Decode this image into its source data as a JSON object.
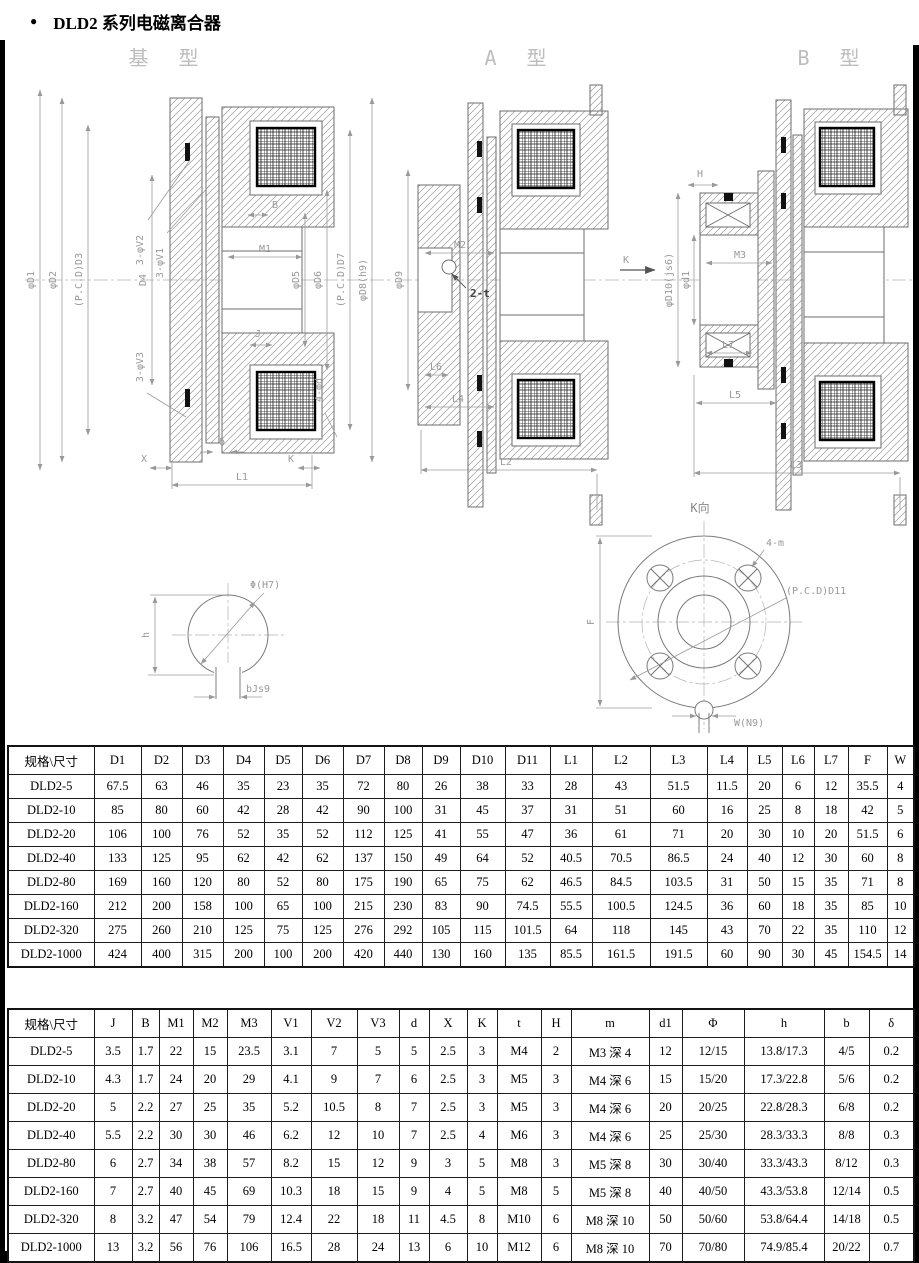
{
  "page": {
    "bullet": "●",
    "title": "DLD2 系列电磁离合器"
  },
  "drawings": {
    "base": {
      "label": "基 型",
      "ann": {
        "phiD1": "φD1",
        "phiD2": "φD2",
        "pcdD3": "(P.C.D)D3",
        "D4": "D4",
        "v2": "3-φV2",
        "v1": "3-φV1",
        "B": "B",
        "M1": "M1",
        "phiD5": "φD5",
        "phiD6": "φD6",
        "pcdD7": "(P.C.D)D7",
        "phiD8": "φD8(h9)",
        "v3": "3-φV3",
        "J": "J",
        "phid": "4-φd",
        "X": "X",
        "delta": "δ",
        "K": "K",
        "L1": "L1"
      }
    },
    "typeA": {
      "label": "A 型",
      "ann": {
        "phiD9": "φD9",
        "M2": "M2",
        "t2": "2-t",
        "L6": "L6",
        "L4": "L4",
        "L2": "L2",
        "K": "K"
      }
    },
    "typeB": {
      "label": "B 型",
      "ann": {
        "H": "H",
        "phiD10": "φD10(js6)",
        "phid1": "φd1",
        "M3": "M3",
        "L7": "L7",
        "L5": "L5",
        "L3": "L3"
      }
    },
    "keyway": {
      "ann": {
        "phi": "Φ(H7)",
        "h": "h",
        "b": "bJs9"
      }
    },
    "flange": {
      "ann": {
        "kview": "K向",
        "m4": "4-m",
        "pcd": "(P.C.D)D11",
        "F": "F",
        "W": "W(N9)"
      }
    }
  },
  "table1": {
    "headers": [
      "规格\\尺寸",
      "D1",
      "D2",
      "D3",
      "D4",
      "D5",
      "D6",
      "D7",
      "D8",
      "D9",
      "D10",
      "D11",
      "L1",
      "L2",
      "L3",
      "L4",
      "L5",
      "L6",
      "L7",
      "F",
      "W"
    ],
    "rows": [
      [
        "DLD2-5",
        "67.5",
        "63",
        "46",
        "35",
        "23",
        "35",
        "72",
        "80",
        "26",
        "38",
        "33",
        "28",
        "43",
        "51.5",
        "11.5",
        "20",
        "6",
        "12",
        "35.5",
        "4"
      ],
      [
        "DLD2-10",
        "85",
        "80",
        "60",
        "42",
        "28",
        "42",
        "90",
        "100",
        "31",
        "45",
        "37",
        "31",
        "51",
        "60",
        "16",
        "25",
        "8",
        "18",
        "42",
        "5"
      ],
      [
        "DLD2-20",
        "106",
        "100",
        "76",
        "52",
        "35",
        "52",
        "112",
        "125",
        "41",
        "55",
        "47",
        "36",
        "61",
        "71",
        "20",
        "30",
        "10",
        "20",
        "51.5",
        "6"
      ],
      [
        "DLD2-40",
        "133",
        "125",
        "95",
        "62",
        "42",
        "62",
        "137",
        "150",
        "49",
        "64",
        "52",
        "40.5",
        "70.5",
        "86.5",
        "24",
        "40",
        "12",
        "30",
        "60",
        "8"
      ],
      [
        "DLD2-80",
        "169",
        "160",
        "120",
        "80",
        "52",
        "80",
        "175",
        "190",
        "65",
        "75",
        "62",
        "46.5",
        "84.5",
        "103.5",
        "31",
        "50",
        "15",
        "35",
        "71",
        "8"
      ],
      [
        "DLD2-160",
        "212",
        "200",
        "158",
        "100",
        "65",
        "100",
        "215",
        "230",
        "83",
        "90",
        "74.5",
        "55.5",
        "100.5",
        "124.5",
        "36",
        "60",
        "18",
        "35",
        "85",
        "10"
      ],
      [
        "DLD2-320",
        "275",
        "260",
        "210",
        "125",
        "75",
        "125",
        "276",
        "292",
        "105",
        "115",
        "101.5",
        "64",
        "118",
        "145",
        "43",
        "70",
        "22",
        "35",
        "110",
        "12"
      ],
      [
        "DLD2-1000",
        "424",
        "400",
        "315",
        "200",
        "100",
        "200",
        "420",
        "440",
        "130",
        "160",
        "135",
        "85.5",
        "161.5",
        "191.5",
        "60",
        "90",
        "30",
        "45",
        "154.5",
        "14"
      ]
    ]
  },
  "table2": {
    "headers": [
      "规格\\尺寸",
      "J",
      "B",
      "M1",
      "M2",
      "M3",
      "V1",
      "V2",
      "V3",
      "d",
      "X",
      "K",
      "t",
      "H",
      "m",
      "d1",
      "Φ",
      "h",
      "b",
      "δ"
    ],
    "rows": [
      [
        "DLD2-5",
        "3.5",
        "1.7",
        "22",
        "15",
        "23.5",
        "3.1",
        "7",
        "5",
        "5",
        "2.5",
        "3",
        "M4",
        "2",
        "M3 深 4",
        "12",
        "12/15",
        "13.8/17.3",
        "4/5",
        "0.2"
      ],
      [
        "DLD2-10",
        "4.3",
        "1.7",
        "24",
        "20",
        "29",
        "4.1",
        "9",
        "7",
        "6",
        "2.5",
        "3",
        "M5",
        "3",
        "M4 深 6",
        "15",
        "15/20",
        "17.3/22.8",
        "5/6",
        "0.2"
      ],
      [
        "DLD2-20",
        "5",
        "2.2",
        "27",
        "25",
        "35",
        "5.2",
        "10.5",
        "8",
        "7",
        "2.5",
        "3",
        "M5",
        "3",
        "M4 深 6",
        "20",
        "20/25",
        "22.8/28.3",
        "6/8",
        "0.2"
      ],
      [
        "DLD2-40",
        "5.5",
        "2.2",
        "30",
        "30",
        "46",
        "6.2",
        "12",
        "10",
        "7",
        "2.5",
        "4",
        "M6",
        "3",
        "M4 深 6",
        "25",
        "25/30",
        "28.3/33.3",
        "8/8",
        "0.3"
      ],
      [
        "DLD2-80",
        "6",
        "2.7",
        "34",
        "38",
        "57",
        "8.2",
        "15",
        "12",
        "9",
        "3",
        "5",
        "M8",
        "3",
        "M5 深 8",
        "30",
        "30/40",
        "33.3/43.3",
        "8/12",
        "0.3"
      ],
      [
        "DLD2-160",
        "7",
        "2.7",
        "40",
        "45",
        "69",
        "10.3",
        "18",
        "15",
        "9",
        "4",
        "5",
        "M8",
        "5",
        "M5 深 8",
        "40",
        "40/50",
        "43.3/53.8",
        "12/14",
        "0.5"
      ],
      [
        "DLD2-320",
        "8",
        "3.2",
        "47",
        "54",
        "79",
        "12.4",
        "22",
        "18",
        "11",
        "4.5",
        "8",
        "M10",
        "6",
        "M8 深 10",
        "50",
        "50/60",
        "53.8/64.4",
        "14/18",
        "0.5"
      ],
      [
        "DLD2-1000",
        "13",
        "3.2",
        "56",
        "76",
        "106",
        "16.5",
        "28",
        "24",
        "13",
        "6",
        "10",
        "M12",
        "6",
        "M8 深 10",
        "70",
        "70/80",
        "74.9/85.4",
        "20/22",
        "0.7"
      ]
    ]
  }
}
